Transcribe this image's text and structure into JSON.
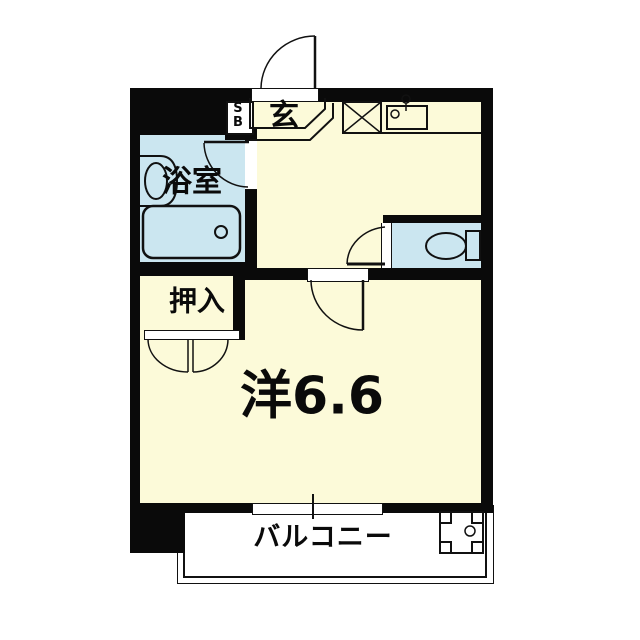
{
  "plan": {
    "type": "apartment-floor-plan",
    "labels": {
      "entrance": "玄",
      "shoe_box": "S\nB",
      "bathroom": "浴室",
      "closet": "押入",
      "main_room": "洋6.6",
      "balcony": "バルコニー"
    },
    "colors": {
      "wall": "#0a0a0a",
      "floor": "#fcfad9",
      "wet_area": "#cbe6f0",
      "balcony": "#ffffff",
      "line": "#111111"
    },
    "fixtures": [
      "entrance-swing-door",
      "shoe-box",
      "genkan-step-outline",
      "washer-pan-x-box",
      "kitchen-sink-with-faucet",
      "washbasin-counter",
      "bathtub",
      "bathroom-swing-door",
      "toilet-bowl-and-tank",
      "toilet-swing-door",
      "main-room-swing-door",
      "closet-double-doors",
      "balcony-sliding-window",
      "balcony-equipment-pan"
    ]
  }
}
